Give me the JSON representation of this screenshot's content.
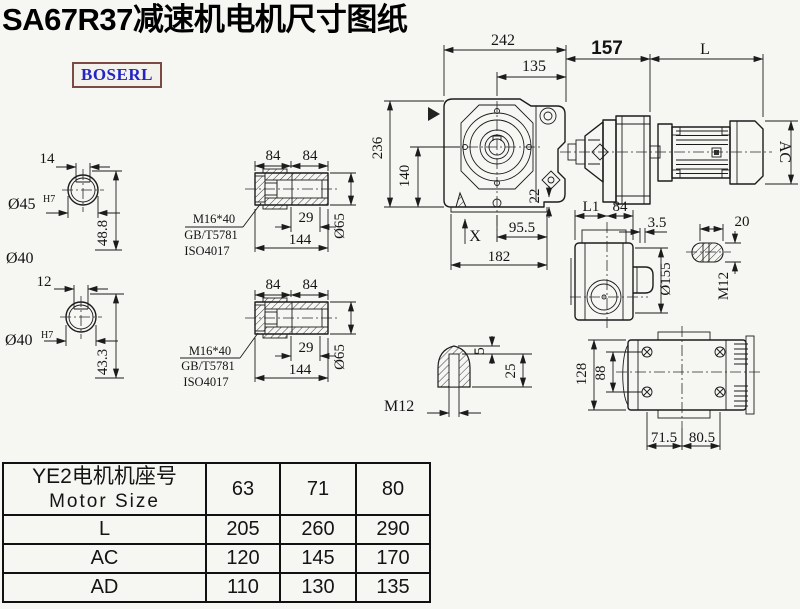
{
  "page": {
    "title": "SA67R37减速机电机尺寸图纸",
    "brand": "BOSERL"
  },
  "colors": {
    "background": "#f6f6f3",
    "line": "#1c1c1c",
    "logo_text": "#2424c4",
    "logo_border": "#7b4a42"
  },
  "dims": {
    "shaft_top": {
      "keyway_width": "14",
      "bore": "Ø45",
      "bore_fit": "H7",
      "depth": "48.8",
      "alt": "Ø40"
    },
    "shaft_bottom": {
      "keyway_width": "12",
      "bore": "Ø40",
      "bore_fit": "H7",
      "depth": "43.3"
    },
    "bushing_top": {
      "seg_a": "84",
      "seg_b": "84",
      "screw": "M16*40",
      "std": "GB/T5781",
      "iso": "ISO4017",
      "bolt_depth": "29",
      "length": "144",
      "dia": "Ø65"
    },
    "bushing_bottom": {
      "seg_a": "84",
      "seg_b": "84",
      "screw": "M16*40",
      "std": "GB/T5781",
      "iso": "ISO4017",
      "bolt_depth": "29",
      "length": "144",
      "dia": "Ø65"
    },
    "front_view": {
      "overall_width": "242",
      "center_to_face": "135",
      "overall_height": "236",
      "axis_height": "140",
      "step": "22",
      "foot_half": "95.5",
      "base_width": "182",
      "mark": "X"
    },
    "motor_view": {
      "adapter_length": "157",
      "motor_length": "L",
      "motor_dia": "AC"
    },
    "side_view": {
      "l1": "L1",
      "w": "84",
      "flange_t": "3.5",
      "plug_len": "20",
      "flange_dia": "Ø155",
      "plug_thread": "M12"
    },
    "plug_detail": {
      "thread": "M12",
      "land": "5",
      "height": "25"
    },
    "top_view": {
      "width": "128",
      "bolt_spacing": "88",
      "left": "71.5",
      "right": "80.5"
    }
  },
  "table": {
    "header_cn": "YE2电机机座号",
    "header_en": "Motor Size",
    "sizes": [
      "63",
      "71",
      "80"
    ],
    "rows": [
      {
        "label": "L",
        "values": [
          "205",
          "260",
          "290"
        ]
      },
      {
        "label": "AC",
        "values": [
          "120",
          "145",
          "170"
        ]
      },
      {
        "label": "AD",
        "values": [
          "110",
          "130",
          "135"
        ]
      }
    ]
  }
}
